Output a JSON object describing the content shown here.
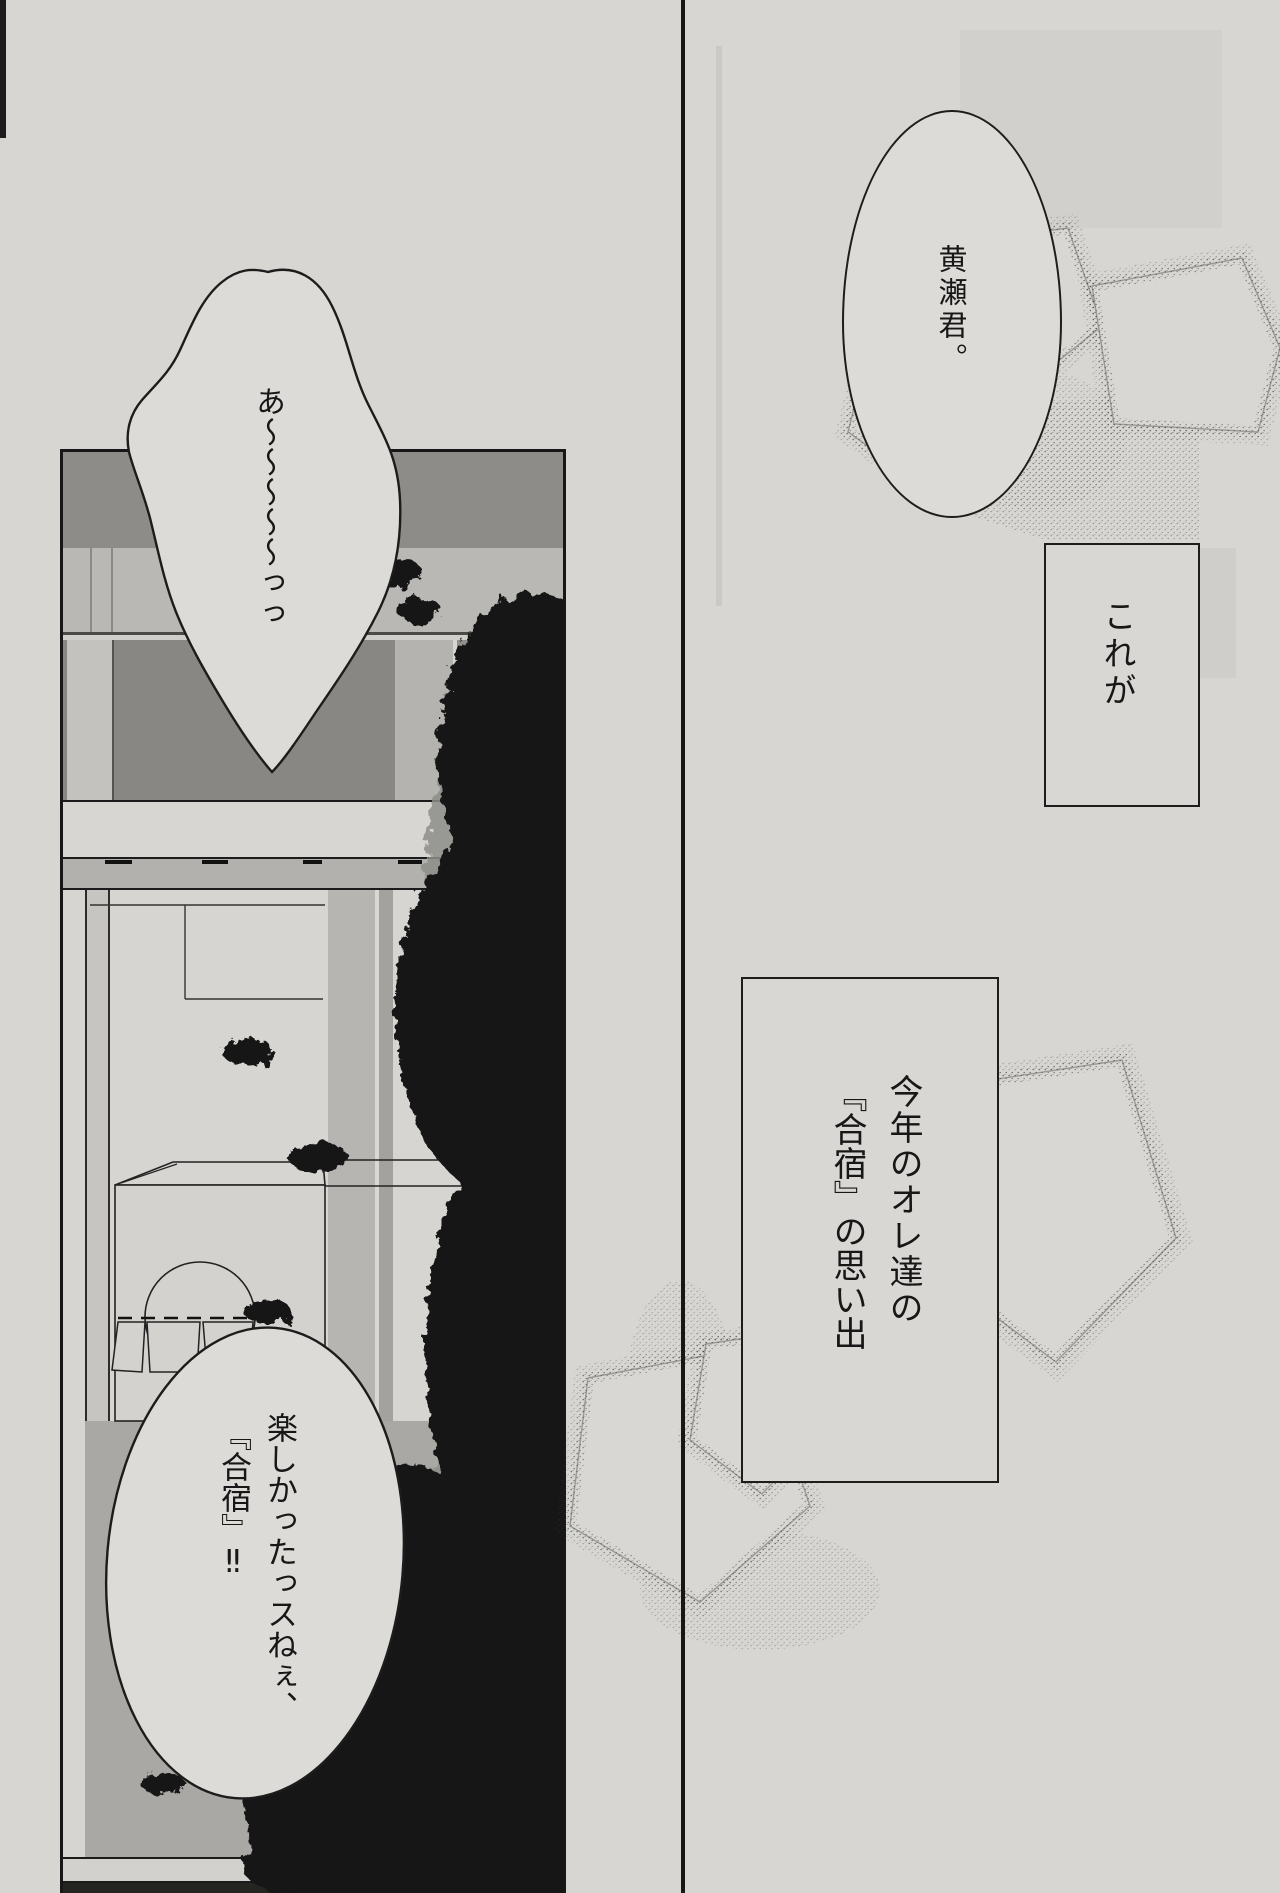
{
  "colors": {
    "paper": "#d7d6d2",
    "ink": "#171717",
    "panel_interior": "#d6d5d1",
    "wall_dark_band": "#8d8c88",
    "wall_light_band": "#b9b8b4",
    "window_beam": "#b2b1ad",
    "floor": "#a9a8a4",
    "foliage": "#131313",
    "bubble_fill": "#dcdbd7"
  },
  "left_panel": {
    "top_bubble": {
      "lead": "あ",
      "squiggle": "〜〜〜〜〜",
      "tail": "っっ"
    },
    "bottom_bubble": {
      "right_column": "楽しかったっスねぇ、",
      "left_column": "『合宿』‼"
    }
  },
  "right_panel": {
    "speech_bubble": "黄瀬君。",
    "caption_small": "これが",
    "caption_large": {
      "right_column": "今年のオレ達の",
      "left_column": "『合宿』の思い出"
    }
  }
}
